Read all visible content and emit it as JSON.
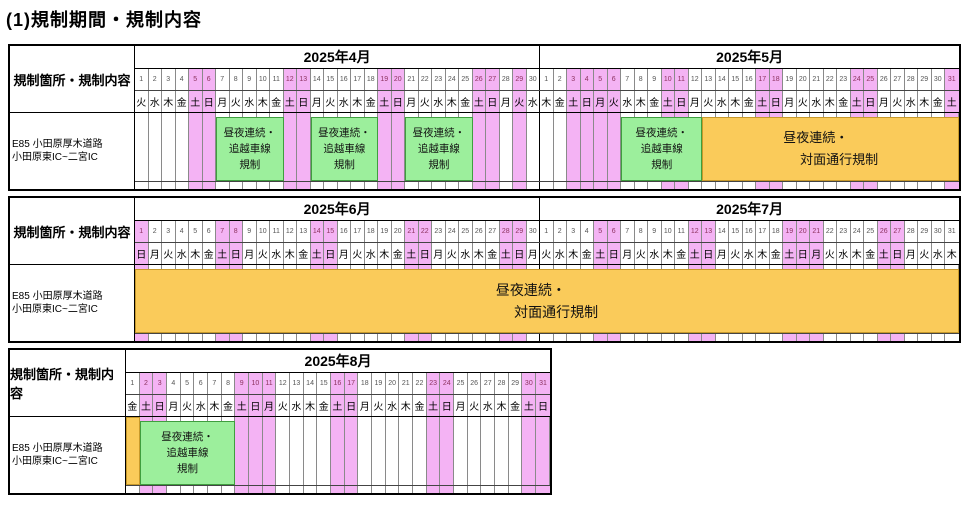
{
  "title": "(1)規制期間・規制内容",
  "colors": {
    "weekend_highlight": "#F4B3F4",
    "lane_regulation_bar": "#9CEF9C",
    "contraflow_regulation_bar": "#FACB5A"
  },
  "row_header": "規制箇所・規制内容",
  "section_label_lines": [
    "E85 小田原厚木道路",
    "小田原東IC~二宮IC"
  ],
  "bar_labels": {
    "lane": [
      "昼夜連続・",
      "追越車線",
      "規制"
    ],
    "contraflow": [
      "昼夜連続・",
      "対面通行規制"
    ]
  },
  "blocks": [
    {
      "months": [
        {
          "name": "2025年4月",
          "days": 30,
          "dows": "火水木金土日月火水木金土日月火水木金土日月火水木金土日月火水",
          "highlight_days": [
            5,
            6,
            12,
            13,
            19,
            20,
            26,
            27,
            29
          ]
        },
        {
          "name": "2025年5月",
          "days": 31,
          "dows": "木金土日月火水木金土日月火水木金土日月火水木金土日月火水木金土",
          "highlight_days": [
            3,
            4,
            5,
            6,
            10,
            11,
            17,
            18,
            24,
            25,
            31
          ]
        }
      ],
      "bars": [
        {
          "kind": "lane",
          "start": 6,
          "span": 5
        },
        {
          "kind": "lane",
          "start": 13,
          "span": 5
        },
        {
          "kind": "lane",
          "start": 20,
          "span": 5
        },
        {
          "kind": "lane",
          "start": 36,
          "span": 6
        },
        {
          "kind": "contraflow",
          "start": 42,
          "span": 19
        }
      ]
    },
    {
      "months": [
        {
          "name": "2025年6月",
          "days": 30,
          "dows": "日月火水木金土日月火水木金土日月火水木金土日月火水木金土日月",
          "highlight_days": [
            1,
            7,
            8,
            14,
            15,
            21,
            22,
            28,
            29
          ]
        },
        {
          "name": "2025年7月",
          "days": 31,
          "dows": "火水木金土日月火水木金土日月火水木金土日月火水木金土日月火水木",
          "highlight_days": [
            5,
            6,
            12,
            13,
            19,
            20,
            21,
            26,
            27
          ]
        }
      ],
      "bars": [
        {
          "kind": "contraflow",
          "start": 0,
          "span": 61,
          "size": "lg"
        }
      ]
    },
    {
      "months": [
        {
          "name": "2025年8月",
          "days": 31,
          "dows": "金土日月火水木金土日月火水木金土日月火水木金土日月火水木金土日",
          "highlight_days": [
            2,
            3,
            9,
            10,
            11,
            16,
            17,
            23,
            24,
            30,
            31
          ]
        }
      ],
      "bars": [
        {
          "kind": "contraflow",
          "start": 0,
          "span": 1,
          "no_label": true,
          "full_height": true
        },
        {
          "kind": "lane",
          "start": 1,
          "span": 7
        }
      ]
    }
  ],
  "chart_data": {
    "type": "table",
    "title": "(1)規制期間・規制内容",
    "row_label": "E85 小田原厚木道路 小田原東IC~二宮IC",
    "months": [
      "2025年4月",
      "2025年5月",
      "2025年6月",
      "2025年7月",
      "2025年8月"
    ],
    "regulation_periods": [
      {
        "regulation": "昼夜連続・追越車線規制",
        "start": "2025-04-07",
        "end": "2025-04-11"
      },
      {
        "regulation": "昼夜連続・追越車線規制",
        "start": "2025-04-14",
        "end": "2025-04-18"
      },
      {
        "regulation": "昼夜連続・追越車線規制",
        "start": "2025-04-21",
        "end": "2025-04-25"
      },
      {
        "regulation": "昼夜連続・追越車線規制",
        "start": "2025-05-07",
        "end": "2025-05-12"
      },
      {
        "regulation": "昼夜連続・対面通行規制",
        "start": "2025-05-13",
        "end": "2025-08-01"
      },
      {
        "regulation": "昼夜連続・追越車線規制",
        "start": "2025-08-02",
        "end": "2025-08-08"
      }
    ],
    "highlighted_day_columns": "weekends and national holidays (pink)"
  }
}
